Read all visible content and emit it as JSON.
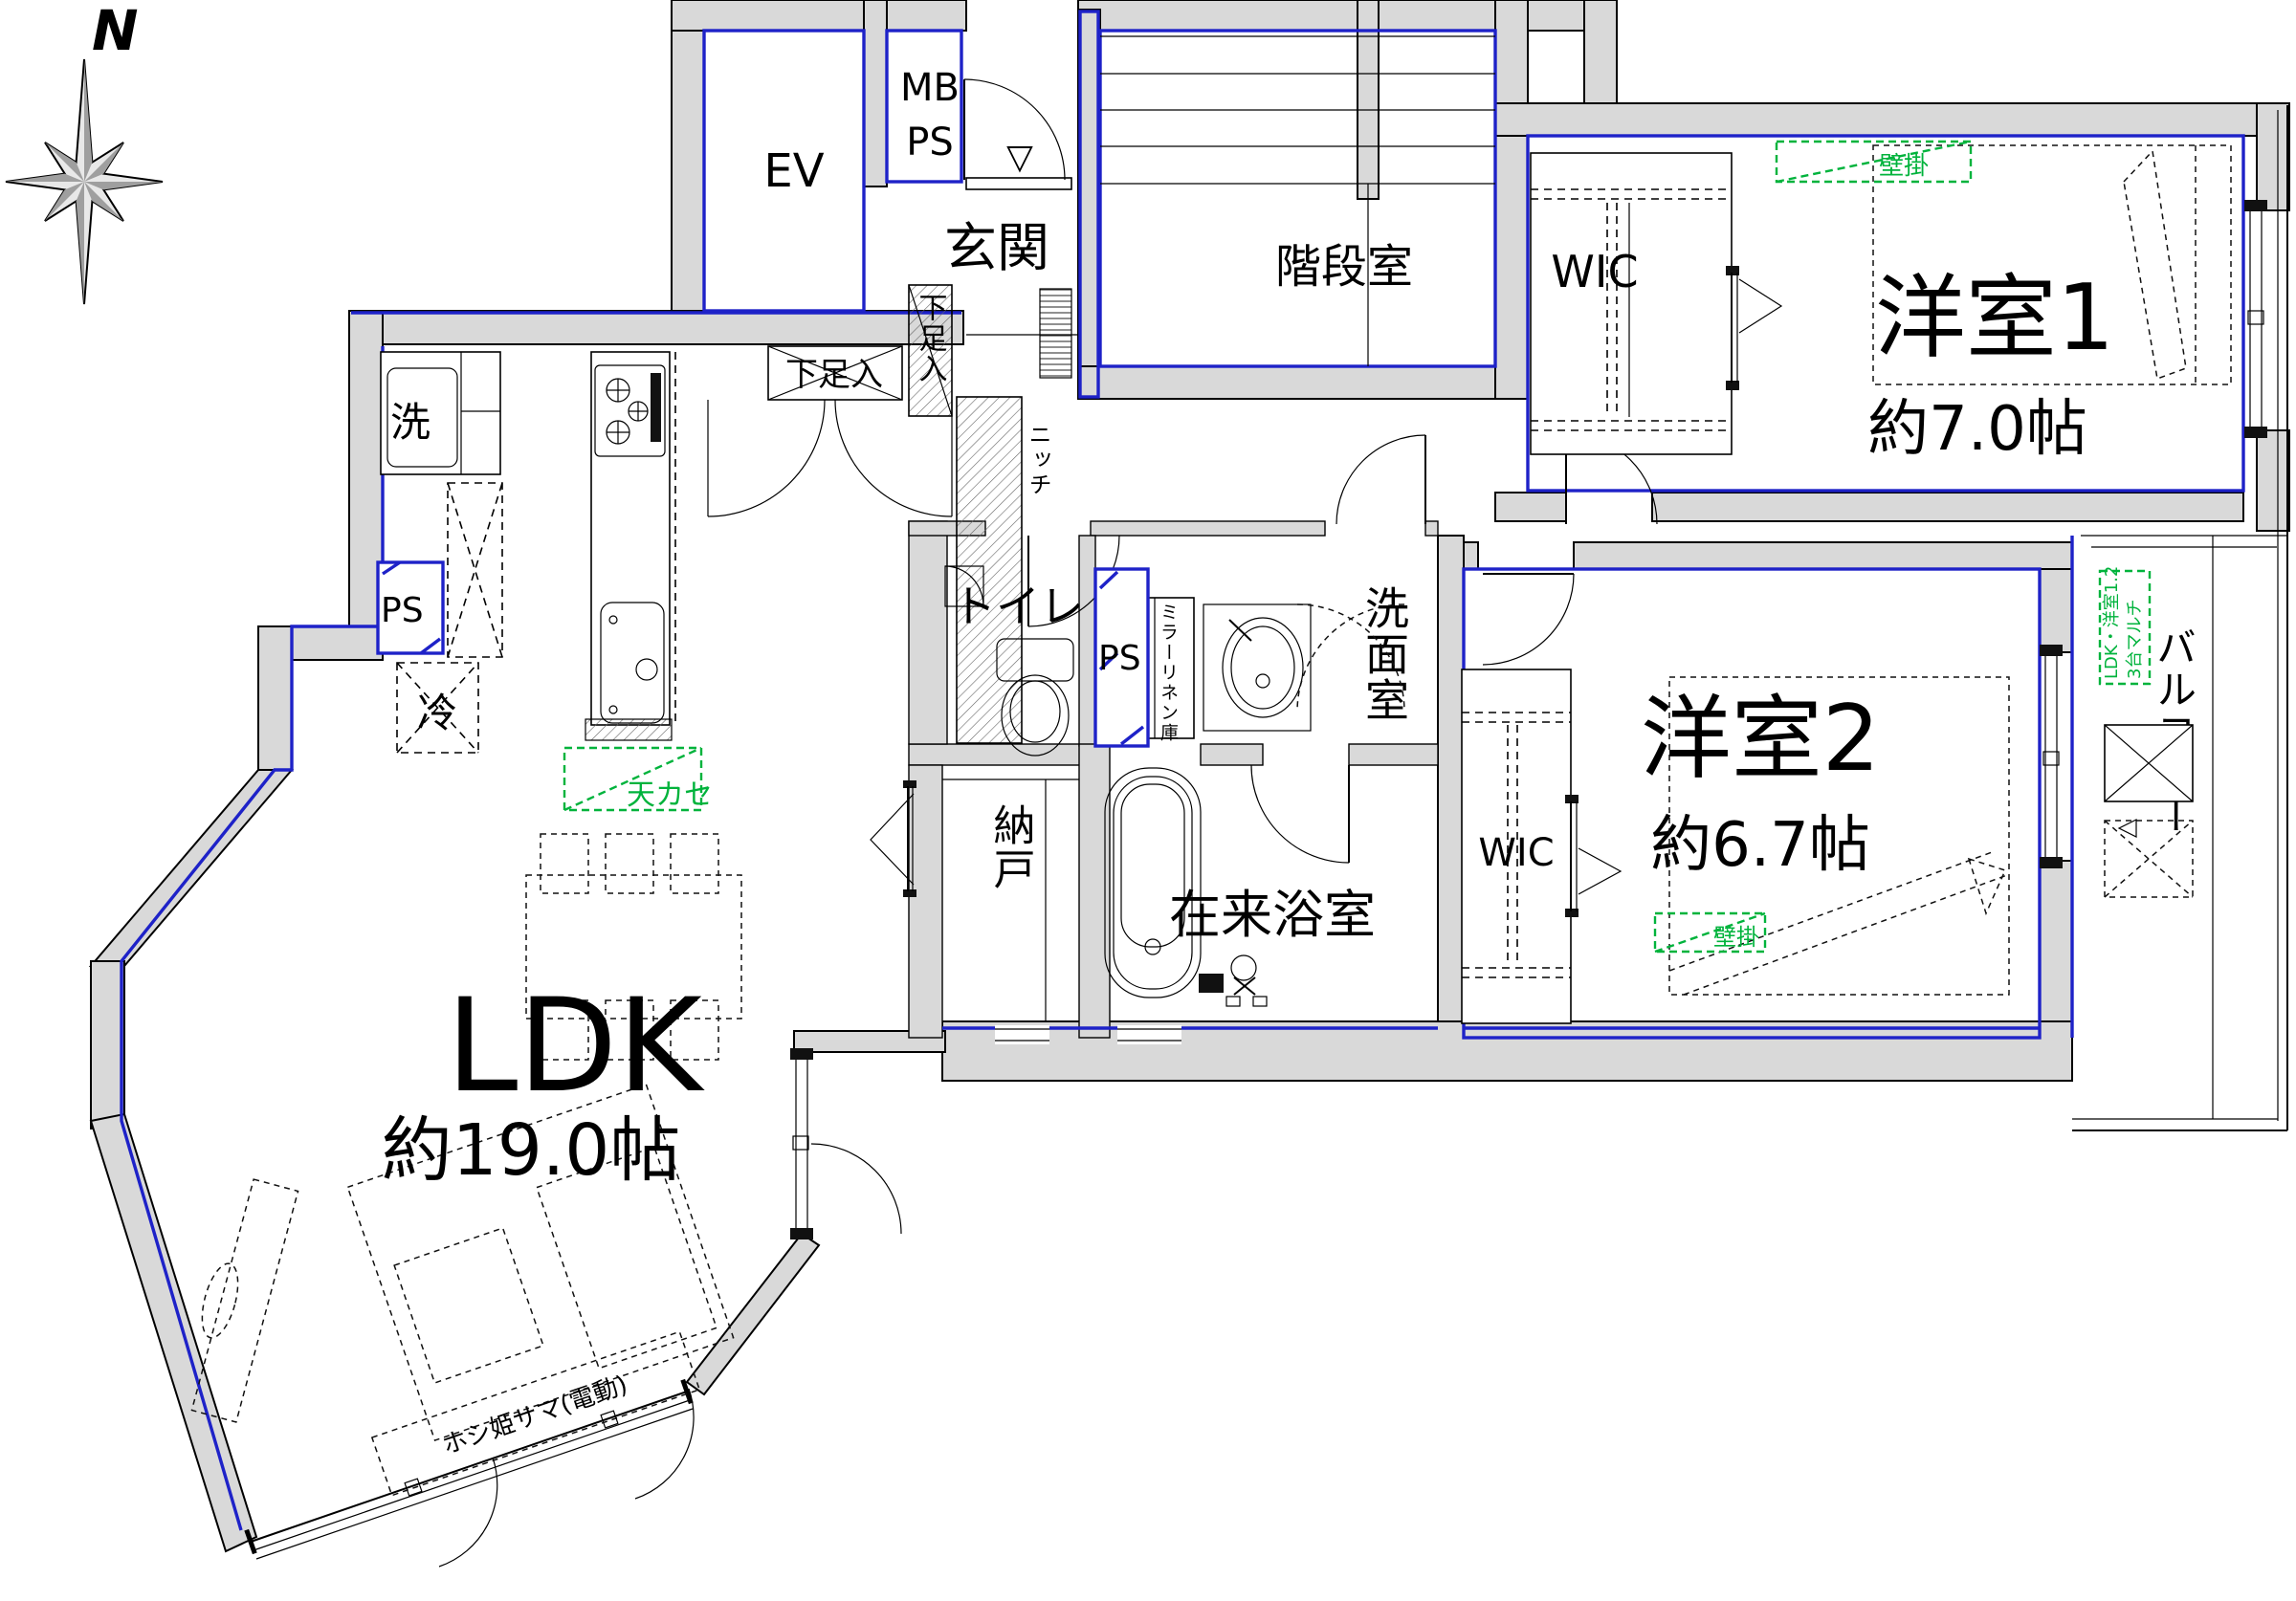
{
  "title": "マンション間取り図 (2LDK floor plan)",
  "colors": {
    "wall_fill": "#d9d9d9",
    "accent_blue": "#1e22c8",
    "annotation_green": "#00b33c",
    "line_black": "#000000",
    "background": "#ffffff"
  },
  "compass": {
    "north_label": "N"
  },
  "rooms": {
    "ev": {
      "label": "EV"
    },
    "mbps": {
      "label_line1": "MB",
      "label_line2": "PS"
    },
    "genkan": {
      "label": "玄関"
    },
    "stairwell": {
      "label": "階段室"
    },
    "wic1": {
      "label": "WIC"
    },
    "bedroom1": {
      "label": "洋室1",
      "size": "約7.0帖"
    },
    "bedroom2": {
      "label": "洋室2",
      "size": "約6.7帖"
    },
    "wic2": {
      "label": "WIC"
    },
    "washroom": {
      "label": "洗面室"
    },
    "toilet": {
      "label": "トイレ"
    },
    "storage": {
      "label": "納戸"
    },
    "bathroom": {
      "label": "在来浴室"
    },
    "ldk": {
      "label": "LDK",
      "size": "約19.0帖"
    },
    "balcony": {
      "label": "バルコニー"
    }
  },
  "fixtures": {
    "washer_label": "洗",
    "fridge_label": "冷",
    "ps_left_label": "PS",
    "ps_mid_label": "PS",
    "niche_label": "ニッチ",
    "shoe_cabinet_h_label": "下足入",
    "shoe_cabinet_v_label": "下足入",
    "mirror_linen_label": "ミラーリネン庫",
    "laundry_pole_label": "ホシ姫サマ(電動)"
  },
  "annotations": {
    "ac_wall_bedroom1": "壁掛",
    "ac_wall_bedroom2": "壁掛",
    "ac_ceiling_ldk": "天カセ",
    "ac_multi_line1": "LDK・洋室1.2",
    "ac_multi_line2": "3台マルチ",
    "entrance_mark": "▽"
  }
}
